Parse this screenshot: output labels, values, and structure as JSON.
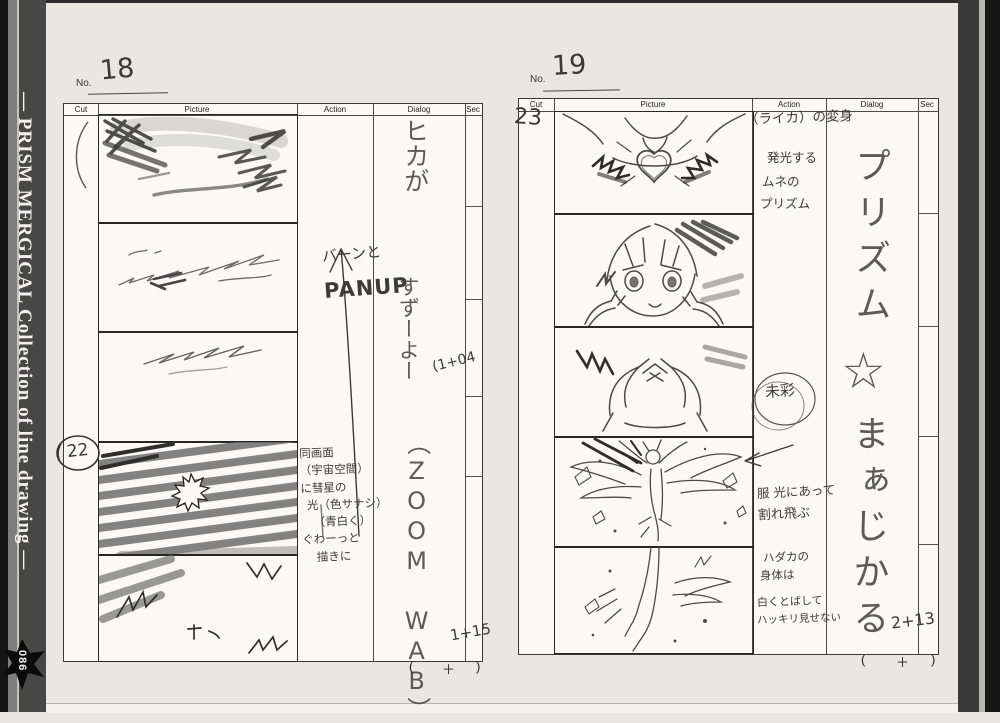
{
  "spine": {
    "title": "— PRISM MERGICAL Collection of line drawing —",
    "page_badge": "086"
  },
  "form": {
    "no_label": "No.",
    "headers": {
      "cut": "Cut",
      "picture": "Picture",
      "action": "Action",
      "dialog": "Dialog",
      "sec": "Sec"
    },
    "total_open": "(",
    "total_plus": "＋",
    "total_close": ")"
  },
  "page18": {
    "page_no": "18",
    "cut_badge": "22",
    "action": {
      "sfx": "バーンと",
      "camera": "PANUP",
      "notes": [
        "同画面",
        "（宇宙空間）",
        "に彗星の",
        "光（色サナシ）",
        "（青白く）",
        "ぐわーっと",
        "描きに"
      ]
    },
    "dialog": {
      "v1": "ヒカが",
      "v2": "すずーよー",
      "v3": "（ZOOM WAB）"
    },
    "sec": {
      "t1": "(1+04",
      "t2": "1+15"
    }
  },
  "page19": {
    "page_no": "19",
    "cut_badge": "23",
    "action": {
      "headnote": "（ライカ）の変身",
      "note1a": "発光する",
      "note1b": "ムネの",
      "note1c": "プリズム",
      "stamp": "未彩",
      "note2a": "服 光にあって",
      "note2b": "割れ飛ぶ",
      "note3a": "ハダカの",
      "note3b": "身体は",
      "note3c": "白くとばして",
      "note3d": "ハッキリ見せない"
    },
    "dialog": {
      "v1": "プリズム",
      "star": "☆",
      "v2": "まぁじかる"
    },
    "sec": {
      "t1": "2+13"
    }
  },
  "colors": {
    "paper": "#e9e7e2",
    "sheet": "#faf9f5",
    "spine": "#474747",
    "pencil": "#474747"
  }
}
